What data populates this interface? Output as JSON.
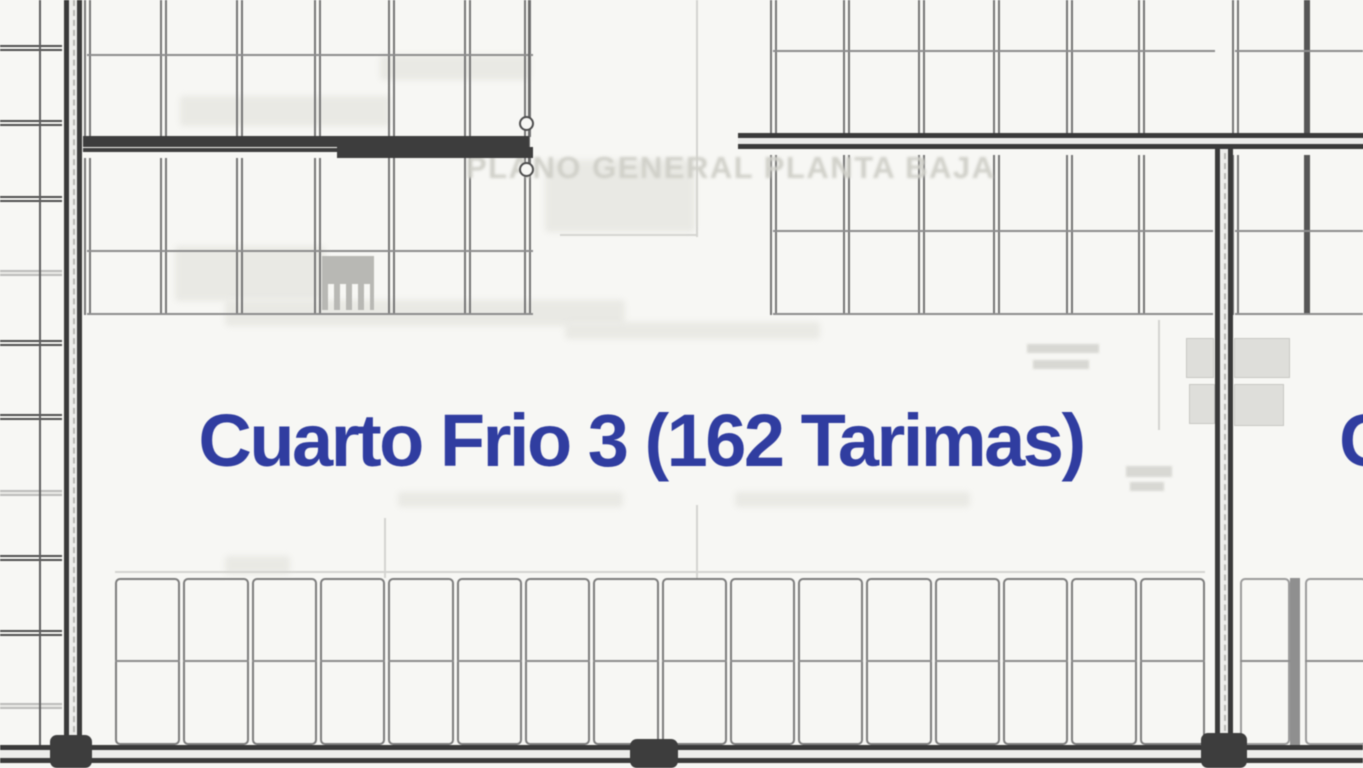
{
  "labels": {
    "room_title": "Cuarto Frio 3 (162 Tarimas)",
    "room_name": "Cuarto Frio 3",
    "capacity_tarimas": 162,
    "adjacent_room_partial": "C",
    "watermark": "PLANO GENERAL PLANTA BAJA"
  },
  "colors": {
    "background": "#f7f7f4",
    "wall": "#3a3a3a",
    "rack_line": "#767676",
    "accent_blue": "#303da0",
    "watermark_gray": "#d0d0c9"
  },
  "plan": {
    "left_strip": {
      "width": 62,
      "divider_x": 39,
      "divider_h": 745,
      "line_ys": [
        45,
        120,
        196,
        340,
        414,
        555,
        630
      ],
      "faint_line_ys": [
        270,
        490,
        703
      ]
    },
    "rack_blocks": [
      {
        "name": "rack-top-left",
        "x": 87,
        "y": 0,
        "w": 446,
        "h": 137,
        "cols": [
          0,
          76,
          152,
          230,
          304,
          380,
          440
        ],
        "rows": [
          54
        ]
      },
      {
        "name": "rack-mid-left",
        "x": 87,
        "y": 158,
        "w": 446,
        "h": 157,
        "cols": [
          0,
          76,
          152,
          230,
          304,
          380,
          440
        ],
        "rows": [
          92
        ],
        "bottom": true
      },
      {
        "name": "rack-top-right",
        "x": 773,
        "y": 0,
        "w": 442,
        "h": 133,
        "cols": [
          0,
          73,
          148,
          223,
          296,
          368
        ],
        "rows": [
          50
        ]
      },
      {
        "name": "rack-mid-right",
        "x": 773,
        "y": 155,
        "w": 440,
        "h": 160,
        "cols": [
          0,
          73,
          148,
          223,
          296,
          368
        ],
        "rows": [
          75
        ],
        "bottom": true
      },
      {
        "name": "rack-far-right-top",
        "x": 1235,
        "y": 0,
        "w": 128,
        "h": 133,
        "cols": [
          0,
          72
        ],
        "rows": [
          50
        ],
        "dark_cols": [
          1
        ]
      },
      {
        "name": "rack-far-right-mid",
        "x": 1235,
        "y": 155,
        "w": 128,
        "h": 160,
        "cols": [
          0,
          72
        ],
        "rows": [
          75
        ],
        "dark_cols": [
          1
        ],
        "bottom": true
      }
    ],
    "bottom_row": {
      "x": 115,
      "y": 578,
      "w": 1090,
      "h": 167,
      "cells": 16,
      "mid": 80
    },
    "bottom_right_cells": [
      {
        "x": 1240,
        "y": 578,
        "w": 50,
        "h": 167,
        "mid": 80
      },
      {
        "x": 1305,
        "y": 578,
        "w": 62,
        "h": 167,
        "mid": 80
      }
    ],
    "bottom_right_divider": {
      "x": 1290,
      "y": 578,
      "w": 10,
      "h": 167
    },
    "walls": {
      "left": {
        "x": 64,
        "y": 0,
        "w": 18,
        "h": 752
      },
      "right": {
        "x": 1215,
        "y": 133,
        "w": 18,
        "h": 618
      },
      "top_right": {
        "x": 738,
        "y": 133,
        "w": 630,
        "h": 16
      },
      "bottom": {
        "x": 0,
        "y": 745,
        "w": 1363,
        "h": 18
      },
      "bars": [
        {
          "x": 83,
          "y": 136,
          "w": 446,
          "h": 11
        },
        {
          "x": 337,
          "y": 147,
          "w": 196,
          "h": 11
        },
        {
          "x": 83,
          "y": 148,
          "w": 256,
          "h": 4
        }
      ],
      "columns": [
        {
          "x": 50,
          "y": 735,
          "w": 42,
          "h": 33
        },
        {
          "x": 630,
          "y": 739,
          "w": 48,
          "h": 29
        },
        {
          "x": 1201,
          "y": 733,
          "w": 46,
          "h": 35
        }
      ]
    },
    "door": {
      "line": {
        "x": 528,
        "y": 0,
        "h": 170
      },
      "circles": [
        {
          "x": 519,
          "y": 116
        },
        {
          "x": 519,
          "y": 162
        }
      ]
    },
    "gray_boxes": [
      {
        "x": 1186,
        "y": 338,
        "w": 28,
        "h": 40
      },
      {
        "x": 1234,
        "y": 338,
        "w": 56,
        "h": 40
      },
      {
        "x": 1189,
        "y": 384,
        "w": 26,
        "h": 40
      },
      {
        "x": 1234,
        "y": 384,
        "w": 50,
        "h": 42
      }
    ],
    "tiny_bars": [
      {
        "x": 1027,
        "y": 344,
        "w": 72,
        "h": 9
      },
      {
        "x": 1033,
        "y": 360,
        "w": 56,
        "h": 9
      },
      {
        "x": 1126,
        "y": 466,
        "w": 46,
        "h": 11
      },
      {
        "x": 1130,
        "y": 482,
        "w": 34,
        "h": 9
      }
    ],
    "smudges": [
      {
        "x": 180,
        "y": 96,
        "w": 210,
        "h": 30
      },
      {
        "x": 380,
        "y": 55,
        "w": 150,
        "h": 25
      },
      {
        "x": 545,
        "y": 160,
        "w": 150,
        "h": 72
      },
      {
        "x": 175,
        "y": 246,
        "w": 150,
        "h": 55
      },
      {
        "x": 225,
        "y": 300,
        "w": 400,
        "h": 26
      },
      {
        "x": 565,
        "y": 322,
        "w": 255,
        "h": 17
      },
      {
        "x": 398,
        "y": 492,
        "w": 225,
        "h": 15
      },
      {
        "x": 735,
        "y": 492,
        "w": 235,
        "h": 15
      },
      {
        "x": 225,
        "y": 556,
        "w": 65,
        "h": 18
      }
    ],
    "faint_lines": [
      {
        "x": 696,
        "y": 0,
        "w": 2,
        "h": 237
      },
      {
        "x": 560,
        "y": 234,
        "w": 138,
        "h": 2
      },
      {
        "x": 384,
        "y": 518,
        "w": 2,
        "h": 60
      },
      {
        "x": 696,
        "y": 505,
        "w": 2,
        "h": 73
      },
      {
        "x": 1158,
        "y": 320,
        "w": 2,
        "h": 110
      },
      {
        "x": 115,
        "y": 571,
        "w": 1090,
        "h": 2
      }
    ],
    "comb": {
      "x": 322,
      "y": 256,
      "w": 52,
      "h": 54,
      "teeth_h": 26
    }
  }
}
